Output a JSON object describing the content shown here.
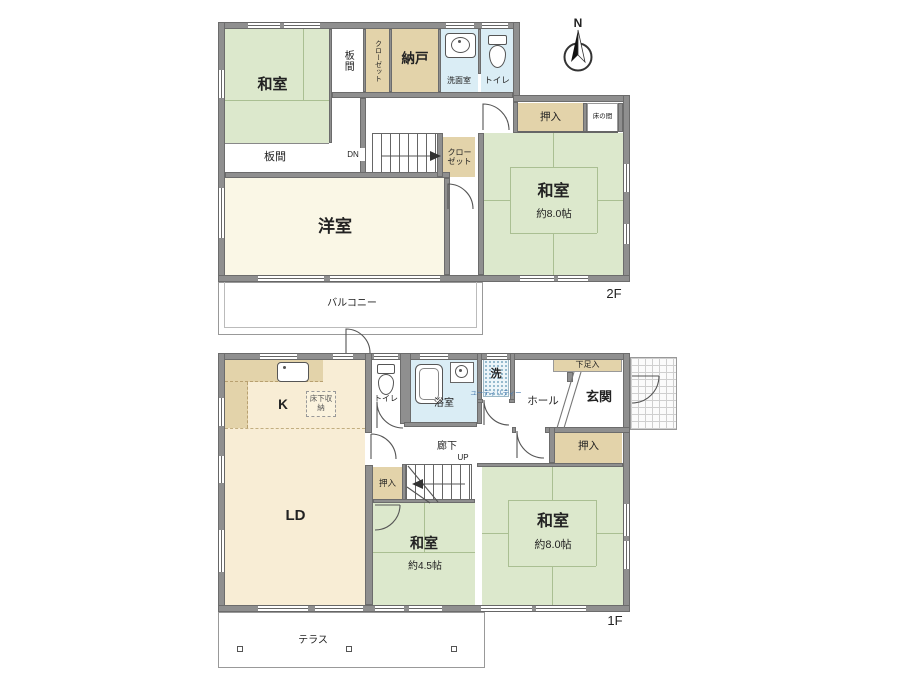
{
  "palette": {
    "wall": "#8f8f8f",
    "tatami_green": "#dce8cc",
    "wood_cream": "#faf7e6",
    "kitchen_cream": "#f8edd5",
    "closet_tan": "#e3d3aa",
    "water_blue": "#daedf5",
    "utility_text": "#4a7cb0"
  },
  "compass": {
    "north_label": "N"
  },
  "floor2": {
    "floor_label": "2F",
    "washitsu_nw": {
      "label": "和室"
    },
    "itama_vertical": {
      "label": "板間"
    },
    "itama_horizontal": {
      "label": "板間"
    },
    "closet_north": {
      "label": "クローゼット"
    },
    "nando": {
      "label": "納戸"
    },
    "senmenshitsu": {
      "label": "洗面室"
    },
    "toilet": {
      "label": "トイレ"
    },
    "oshiire": {
      "label": "押入"
    },
    "tokonoma": {
      "label": "床の間"
    },
    "washitsu_east": {
      "label": "和室",
      "size": "約8.0帖"
    },
    "closet_mid": {
      "label": "クローゼット"
    },
    "stairs": {
      "label": "DN"
    },
    "yoshitsu": {
      "label": "洋室"
    },
    "balcony": {
      "label": "バルコニー"
    }
  },
  "floor1": {
    "floor_label": "1F",
    "kitchen": {
      "label": "K"
    },
    "yukashita": {
      "label": "床下収納"
    },
    "toilet": {
      "label": "トイレ"
    },
    "bath": {
      "label": "浴室"
    },
    "laundry": {
      "label": "洗",
      "sub": "ユーティリティー"
    },
    "hall": {
      "label": "ホール"
    },
    "genkan": {
      "label": "玄関"
    },
    "shoe_cabinet": {
      "label": "下足入"
    },
    "corridor": {
      "label": "廊下"
    },
    "stairs": {
      "label": "UP"
    },
    "oshiire_stair": {
      "label": "押入"
    },
    "oshiire_east": {
      "label": "押入"
    },
    "washitsu_center": {
      "label": "和室",
      "size": "約4.5帖"
    },
    "washitsu_east": {
      "label": "和室",
      "size": "約8.0帖"
    },
    "ld": {
      "label": "LD"
    },
    "terrace": {
      "label": "テラス"
    }
  }
}
